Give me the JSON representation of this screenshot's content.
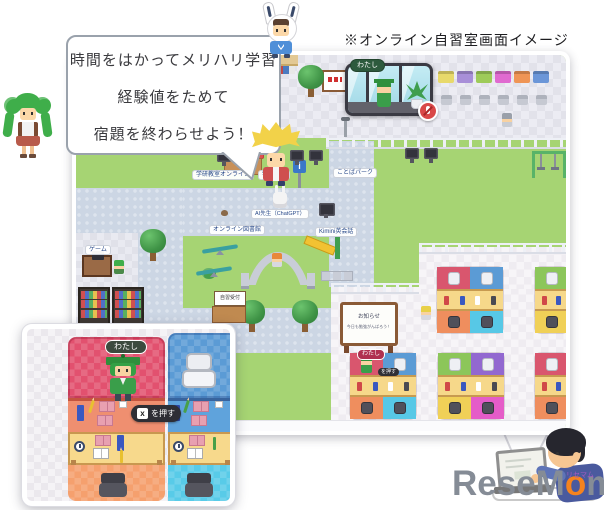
{
  "caption": "※オンライン自習室画面イメージ",
  "bubble": {
    "line1": "時間をはかってメリハリ学習",
    "line2": "経験値をためて",
    "line3": "宿題を終わらせよう！"
  },
  "map": {
    "video_panel": {
      "label": "わたし",
      "mic_state": "muted"
    },
    "labels": {
      "gakken_online": "学研教室オンライン",
      "gakken": "学研教室",
      "kotoba_park": "ことばパーク",
      "ai_teacher": "AI先生（ChatGPT）",
      "online_library": "オンライン図書館",
      "kimini": "Kimini英会話",
      "game": "ゲーム",
      "reception": "自習受付",
      "info": "i"
    },
    "whiteboard": {
      "line1": "お知らせ",
      "line2": "今日も勉強がんばろう！"
    },
    "desk_row_colors": [
      "#e8d96b",
      "#a88fd8",
      "#9ecb59",
      "#e06ad0",
      "#ef9556",
      "#6b96d8"
    ],
    "booths": [
      {
        "id": "r1a",
        "half": false,
        "tl": "#d9566e",
        "tr": "#5b9bd5",
        "bl": "#ef8e5e",
        "br": "#57c8e6"
      },
      {
        "id": "r1b",
        "half": true,
        "tl": "#8cc65a",
        "bl": "#f0d057"
      },
      {
        "id": "r2a",
        "half": false,
        "tl": "#d9566e",
        "tr": "#5b9bd5",
        "bl": "#ef8e5e",
        "br": "#57c8e6",
        "label": "わたし",
        "tooltip": "を押す"
      },
      {
        "id": "r2b",
        "half": false,
        "tl": "#8cc65a",
        "tr": "#9268d0",
        "bl": "#f0d057",
        "br": "#e55cc8"
      },
      {
        "id": "r2c",
        "half": true,
        "tl": "#d9566e",
        "bl": "#ef8e5e"
      }
    ]
  },
  "inset": {
    "player_label": "わたし",
    "tooltip_key": "x",
    "tooltip_text": "を押す"
  },
  "logo": {
    "pre": "ReseM",
    "accent": "o",
    "post": "m",
    "ruby": "リセマム"
  },
  "colors": {
    "grass": "#a6d473",
    "path": "#ccd6e4",
    "accent_orange": "#f5831f"
  }
}
